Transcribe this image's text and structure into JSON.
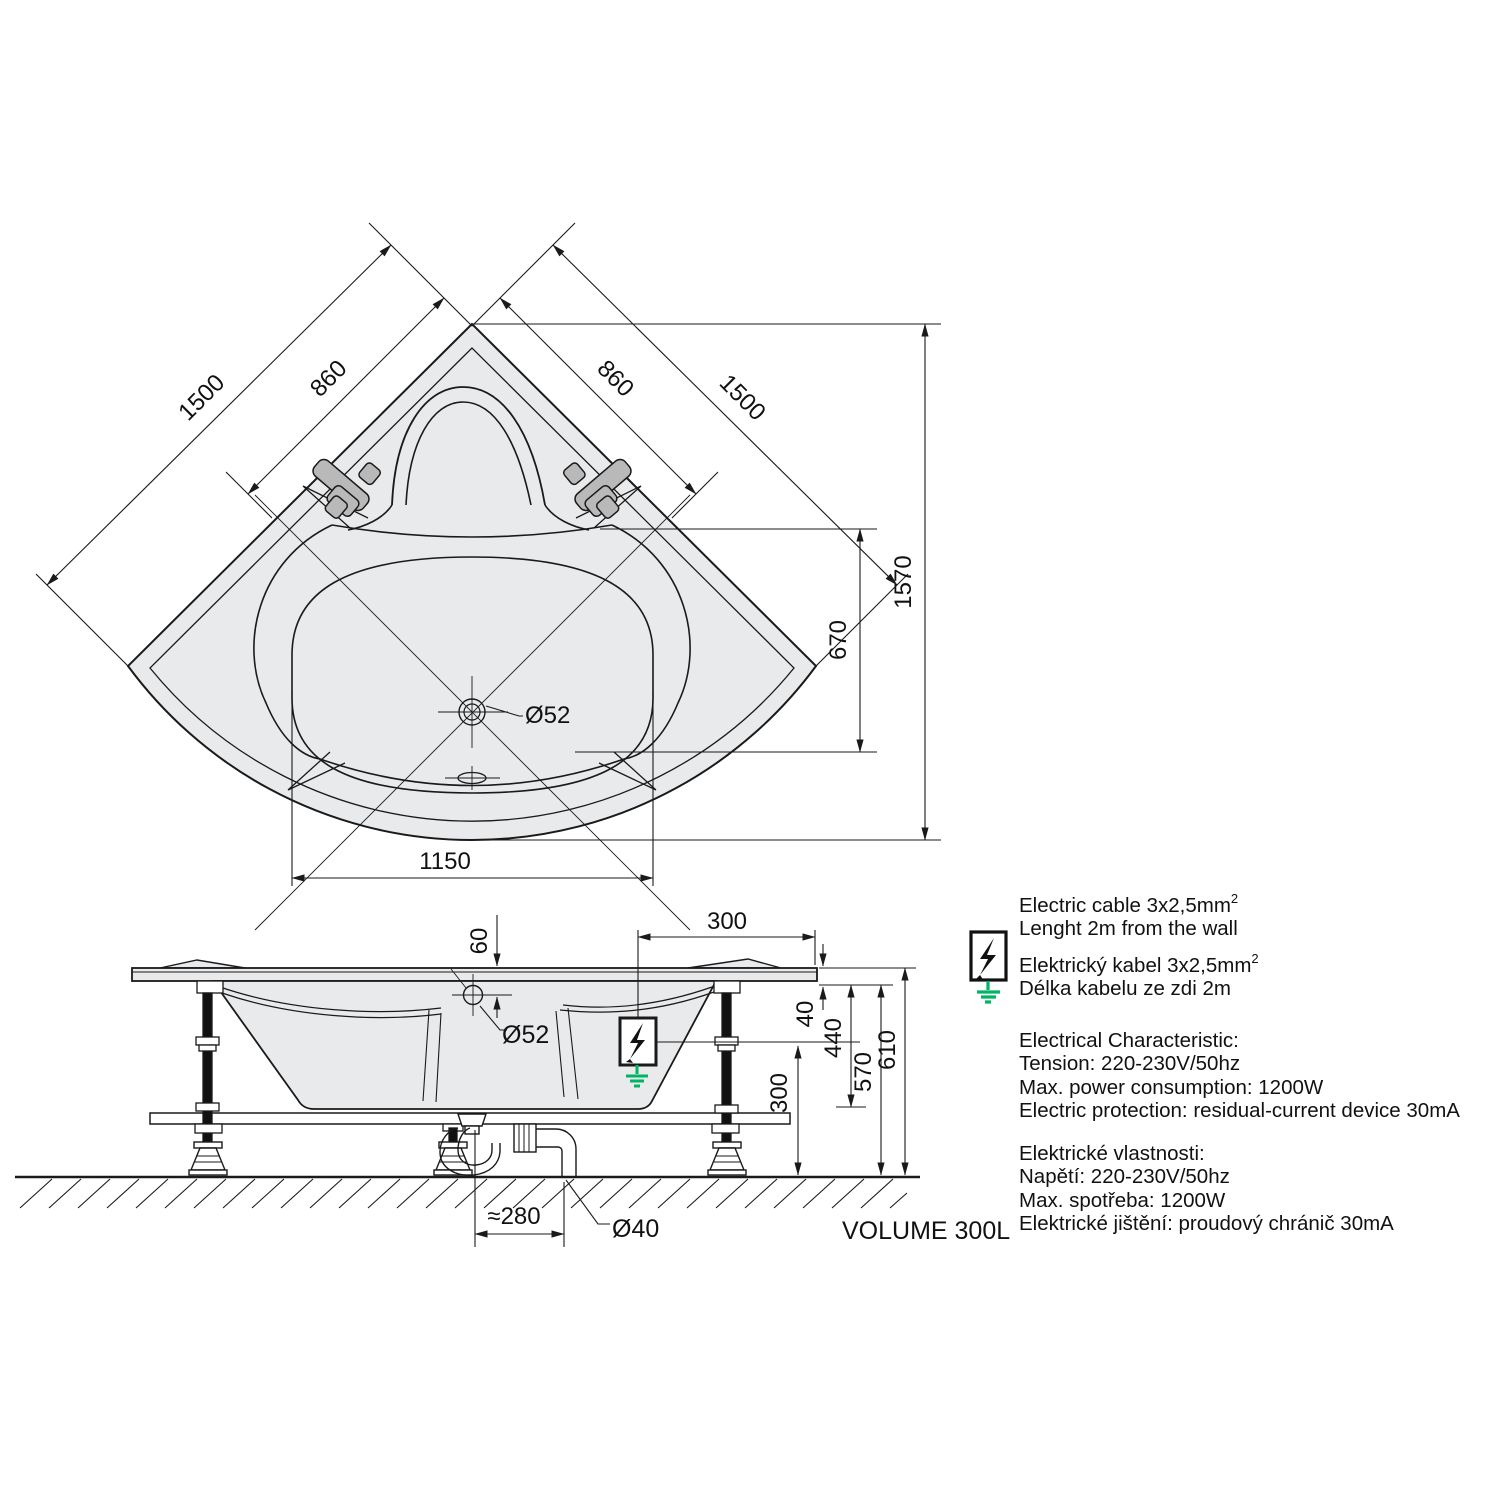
{
  "drawing_type": "corner bathtub installation diagram",
  "plan": {
    "dim_side_left": "1500",
    "dim_inner_left": "860",
    "dim_inner_right": "860",
    "dim_side_right": "1500",
    "dim_overall_depth": "1570",
    "dim_basin_depth": "670",
    "dim_floor_width": "1150",
    "drain_diameter": "Ø52"
  },
  "side": {
    "dim_overflow_offset": "60",
    "dim_cable_offset": "300",
    "dim_rim_thickness": "40",
    "dim_body_depth": "440",
    "dim_under_rim_height": "570",
    "dim_total_height": "610",
    "dim_connection_height": "300",
    "dim_trap_offset": "≈280",
    "pipe_diameter": "Ø40",
    "overflow_diameter": "Ø52"
  },
  "volume_label": "VOLUME 300L",
  "notes": {
    "en_cable_1": "Electric cable 3x2,5mm",
    "en_cable_1_sup": "2",
    "en_cable_2": "Lenght 2m from the wall",
    "cz_cable_1": "Elektrický kabel 3x2,5mm",
    "cz_cable_1_sup": "2",
    "cz_cable_2": "Délka kabelu ze zdi 2m",
    "en_elec_title": "Electrical Characteristic:",
    "en_elec_1": "Tension: 220-230V/50hz",
    "en_elec_2": "Max. power consumption: 1200W",
    "en_elec_3": "Electric protection: residual-current device 30mA",
    "cz_elec_title": "Elektrické vlastnosti:",
    "cz_elec_1": "Napětí: 220-230V/50hz",
    "cz_elec_2": "Max. spotřeba: 1200W",
    "cz_elec_3": "Elektrické jištění: proudový chránič 30mA"
  },
  "colors": {
    "line": "#1a1a1a",
    "tub_fill": "#e9eaec",
    "fitting_fill": "#b9b9b9",
    "ground_green": "#00b464"
  }
}
